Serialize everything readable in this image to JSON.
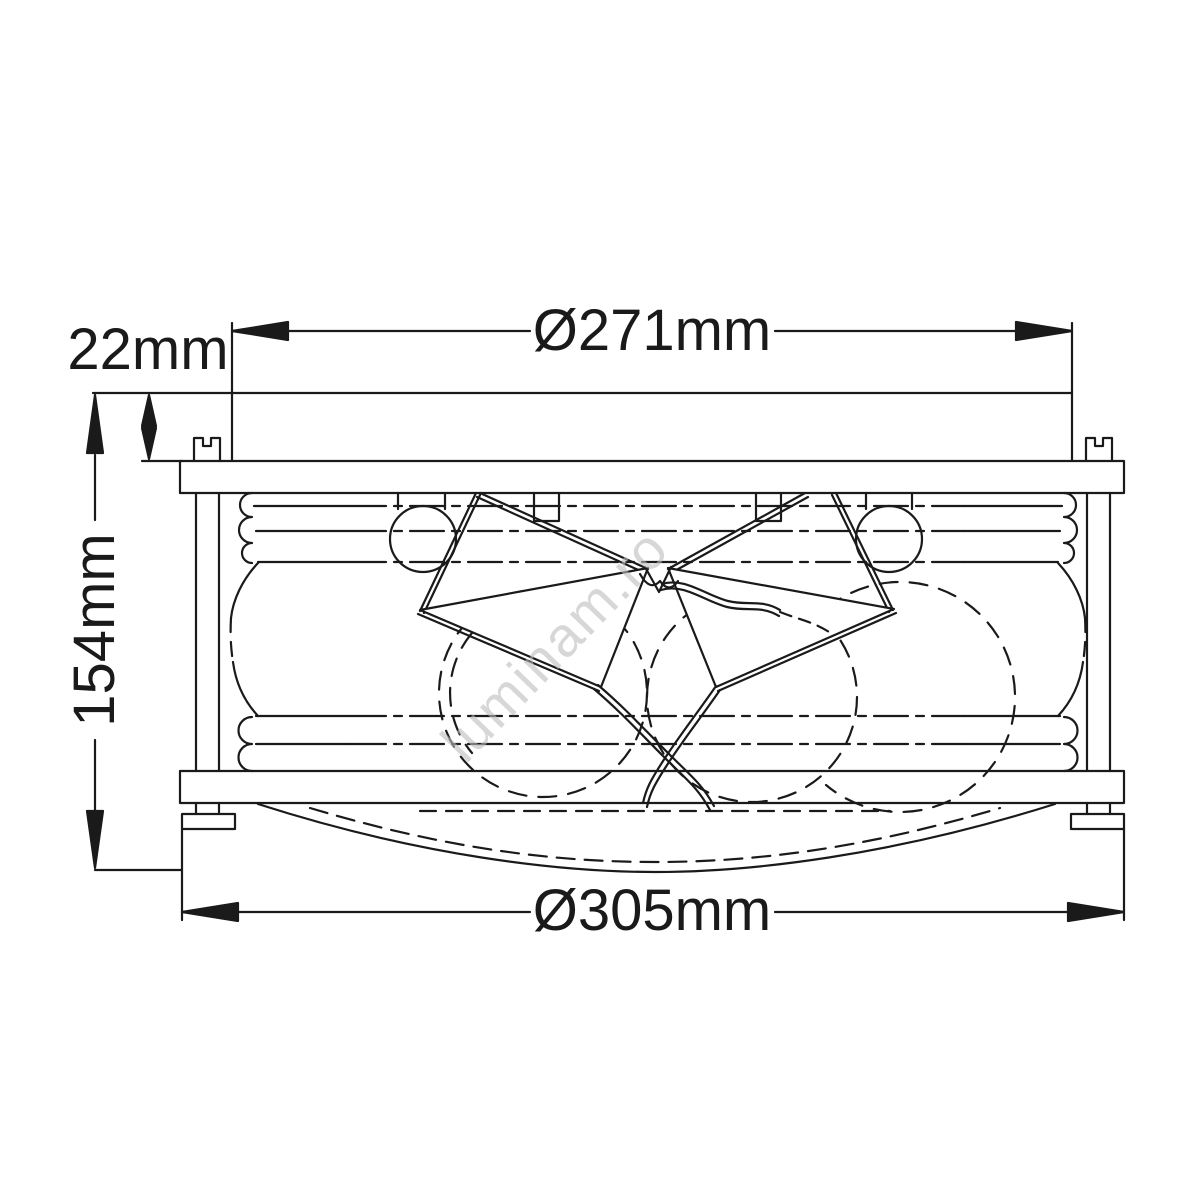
{
  "page": {
    "background": "#ffffff"
  },
  "drawing": {
    "type": "technical-diagram",
    "subject": "flush-mount ceiling light fixture, side elevation with dimensions",
    "line_color": "#1a1a1a",
    "dimensions": {
      "top_diameter": "Ø271mm",
      "canopy_height": "22mm",
      "body_height": "154mm",
      "bottom_diameter": "Ø305mm"
    },
    "watermark": {
      "text": "luminam.ro",
      "color": "#bdbdbd"
    }
  }
}
